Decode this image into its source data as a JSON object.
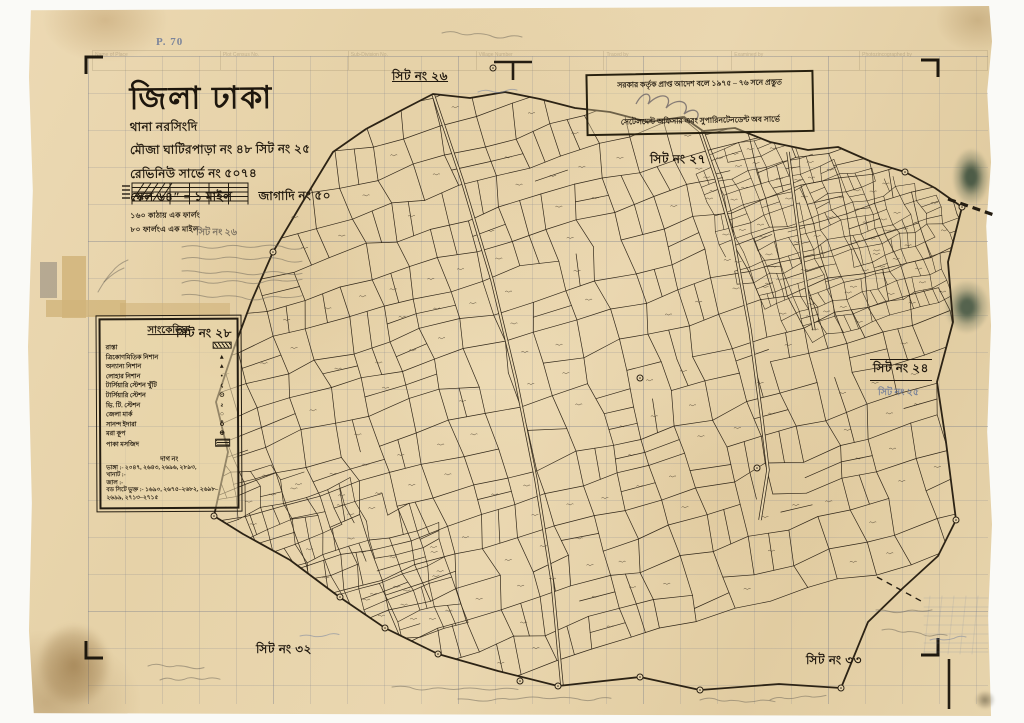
{
  "paper": {
    "background": "#e8d5ad",
    "ink": "#32281a",
    "pencil": "#6e6557",
    "blue_pencil": "#6f7fa0",
    "stain_green": "#4d5c47"
  },
  "title_block": {
    "district": "জিলা ঢাকা",
    "thana": "থানা  নরসিংদি",
    "mouza": "মৌজা  ঘাটিরপাড়া নং ৪৮ সিট নং ২৫",
    "revenue": "রেভিনিউ সার্ভে নং ৫০৭৪",
    "scale": "স্কেল ৬৪″ = ১ মাইল",
    "jl": "জাগাদি নং ৫০",
    "scale_note1": "১৬০ কাঠায় এক ফার্লং",
    "scale_note2": "৮০ ফার্লংএ এক মাইল"
  },
  "stamp": {
    "line1": "সরকার কর্তৃক প্রাপ্ত আদেশ বলে ১৯৭৫ – ৭৬ সনে প্রস্তুত",
    "line2": "সেটেলমেন্ট অফিসার এবং সুপারিনটেনডেন্ট অব সার্ভে"
  },
  "legend": {
    "title": "সাংকেতিক",
    "items": [
      {
        "label": "রাস্তা",
        "symbol": "hatched-bar"
      },
      {
        "label": "ত্রিকোণমিতিক নিশান",
        "symbol": "▲"
      },
      {
        "label": "অন্যান্য নিশান",
        "symbol": "▴"
      },
      {
        "label": "লোহার নিশান",
        "symbol": "•"
      },
      {
        "label": "টার্সিয়ারি স্টেশন খুঁটি",
        "symbol": "ϛ"
      },
      {
        "label": "টার্সিয়ারি স্টেশন",
        "symbol": "⊙"
      },
      {
        "label": "ভি. টি. স্টেশন",
        "symbol": "ƨ"
      },
      {
        "label": "জেলা মার্ক",
        "symbol": "○"
      },
      {
        "label": "সানন্দ ইদারা",
        "symbol": "♁"
      },
      {
        "label": "মরা কূপ",
        "symbol": "⊕"
      },
      {
        "label": "পাকা মসজিদ",
        "symbol": "hatched-block"
      }
    ],
    "notes_heading": "দাগ নং",
    "notes": [
      "ভাঙ্গা :- ২০৪৭, ২৬৪৩, ২৬৯৬, ২৮৯৩,",
      "খানাট :-",
      "জাল :-",
      "বড সিটে ভুক্ত :- ১৬৯০, ২৬৭৫–২৬৮২, ২৬৯৮–২৬৯৯, ২৭১৩–২৭১৫"
    ]
  },
  "sheet_labels": {
    "top": "সিট নং ২৬",
    "upper_right": "সিট নং ২৭",
    "right": "সিট নং ২৪",
    "right_pencil": "সিট নং ২৫",
    "left": "সিট নং ২৮",
    "bottom_left": "সিট নং ৩২",
    "bottom_right": "সিট নং ৩৩"
  },
  "pencil_notes": {
    "page_mark": "P. 70",
    "note_heading": "সিট নং  ২৬"
  },
  "form_strip": {
    "columns": [
      "Name of Place",
      "Plot Census No.",
      "Sub-Division No.",
      "Village Number",
      "Traced by",
      "Examined by",
      "Photozincographed by"
    ]
  }
}
